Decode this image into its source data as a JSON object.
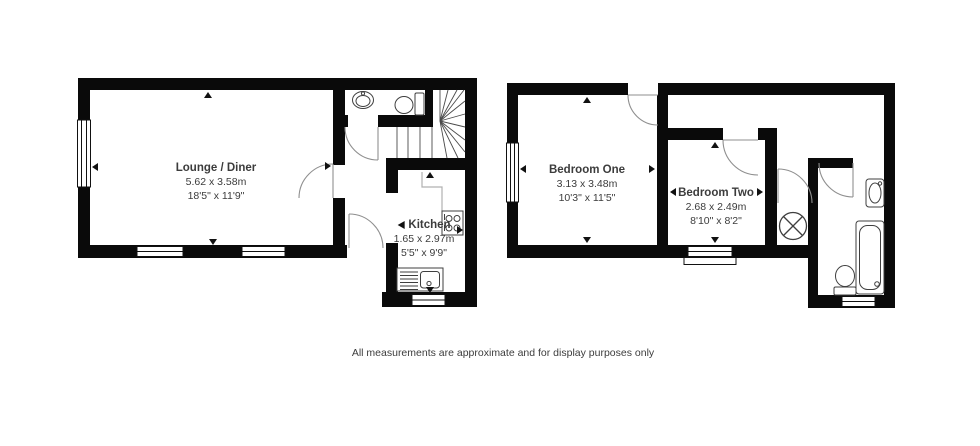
{
  "plans": [
    {
      "id": "ground-floor",
      "rooms": [
        {
          "name": "Lounge / Diner",
          "metric": "5.62 x 3.58m",
          "imperial": "18'5\" x 11'9\""
        },
        {
          "name": "Kitchen",
          "metric": "1.65 x 2.97m",
          "imperial": "5'5\" x 9'9\""
        }
      ]
    },
    {
      "id": "first-floor",
      "rooms": [
        {
          "name": "Bedroom One",
          "metric": "3.13 x 3.48m",
          "imperial": "10'3\" x 11'5\""
        },
        {
          "name": "Bedroom Two",
          "metric": "2.68 x 2.49m",
          "imperial": "8'10\" x 8'2\""
        }
      ]
    }
  ],
  "footer": {
    "disclaimer": "All measurements are approximate and for display purposes only"
  },
  "colors": {
    "wall": "#0a0a0a",
    "fixture": "#3f3f3f",
    "arc": "#8f8f8f",
    "counter": "#b0b0b0",
    "text": "#3c3c3c"
  }
}
